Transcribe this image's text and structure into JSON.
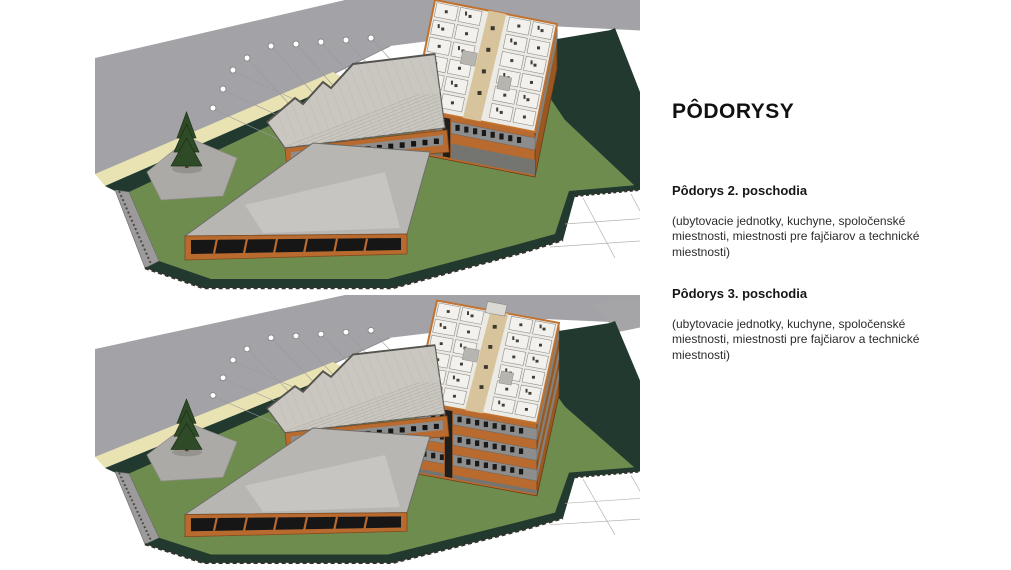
{
  "document": {
    "title": "PÔDORYSY",
    "sections": [
      {
        "heading": "Pôdorys 2. poschodia",
        "body": "(ubytovacie jednotky, kuchyne, spoločenské miestnosti, miestnosti pre fajčiarov a technické miestnosti)"
      },
      {
        "heading": "Pôdorys 3. poschodia",
        "body": "(ubytovacie jednotky, kuchyne, spoločenské miestnosti, miestnosti pre fajčiarov a technické miestnosti)"
      }
    ]
  },
  "figures": [
    {
      "window_bands": 1,
      "building_height": 45,
      "entrance_stub": false,
      "roof_wedge": false
    },
    {
      "window_bands": 3,
      "building_height": 78,
      "entrance_stub": true,
      "roof_wedge": true
    }
  ],
  "colors": {
    "page_bg": "#ffffff",
    "road": "#a3a3a7",
    "sidewalk": "#e9e2b3",
    "lawn": "#6f8c4f",
    "dark_green": "#21392e",
    "plaza": "#acaaa7",
    "roof_flat": "#b8b6b2",
    "roof_ribbed": "#cac7c0",
    "facade_orange": "#b96a2e",
    "facade_orange_dark": "#9a571f",
    "glazing": "#161616",
    "window_band": "#8d8d8d",
    "floor_plate": "#eceae5",
    "floor_corridor": "#d8c49c",
    "floor_room": "#f2f1ee",
    "wall_cut": "#c1722f",
    "furniture": "#433d34",
    "tree": "#2e4a26",
    "grid_line": "#9a9a9a"
  }
}
